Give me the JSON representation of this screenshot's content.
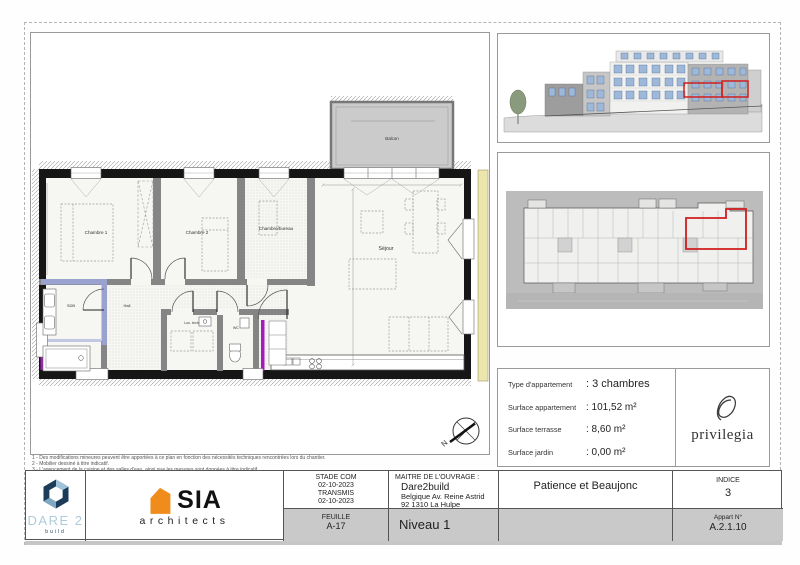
{
  "plan": {
    "rooms": {
      "chambre1": "Chambre 1",
      "chambre2": "Chambre 2",
      "bureau": "Chambre/bureau",
      "sejour": "Séjour",
      "sdb": "SDB",
      "hall": "Hall",
      "loctech": "Loc. tech.",
      "wc": "WC",
      "balcon": "Balcon"
    },
    "compass_label": "N"
  },
  "notes": {
    "line1": "1 - Des modifications mineures peuvent être apportées à ce plan en fonction des nécessités techniques rencontrées lors du chantier.",
    "line2": "2 - Mobilier dessiné à titre indicatif.",
    "line3": "3 - L'agencement de la cuisine et des salles d'eau, ainsi que les mesures sont données à titre indicatif."
  },
  "info_panel": {
    "rows": [
      {
        "label": "Type d'appartement",
        "value": ": 3 chambres"
      },
      {
        "label": "Surface appartement",
        "value": ": 101,52 m²"
      },
      {
        "label": "Surface terrasse",
        "value": ": 8,60 m²"
      },
      {
        "label": "Surface jardin",
        "value": ": 0,00 m²"
      }
    ]
  },
  "privilegia": {
    "wordmark": "privilegia"
  },
  "titleblock": {
    "stade_line1": "STADE COM",
    "stade_line2": "02-10-2023",
    "stade_line3": "TRANSMIS",
    "stade_line4": "02-10-2023",
    "feuille_label": "FEUILLE",
    "feuille_value": "A-17",
    "maitre_label": "MAITRE DE L'OUVRAGE :",
    "maitre_name": "Dare2build",
    "maitre_address": "Belgique Av. Reine Astrid 92   1310 La Hulpe",
    "niveau": "Niveau 1",
    "dare_line1": "DARE 2",
    "dare_line2": "build",
    "sia_name": "SIA",
    "sia_sub": "architects",
    "project": "Patience et Beaujonc",
    "indice_label": "INDICE",
    "indice_value": "3",
    "appart_label": "Appart N°",
    "appart_value": "A.2.1.10"
  },
  "colors": {
    "highlight_red": "#cf1d1d",
    "accent_purple": "#a21cbd",
    "accent_periwinkle": "#9aa3cf",
    "adjacent_yellow": "#ece5ad",
    "sia_orange": "#ef8c1c",
    "dare_navy": "#1d3c59",
    "dare_lightblue": "#aecbdd"
  }
}
